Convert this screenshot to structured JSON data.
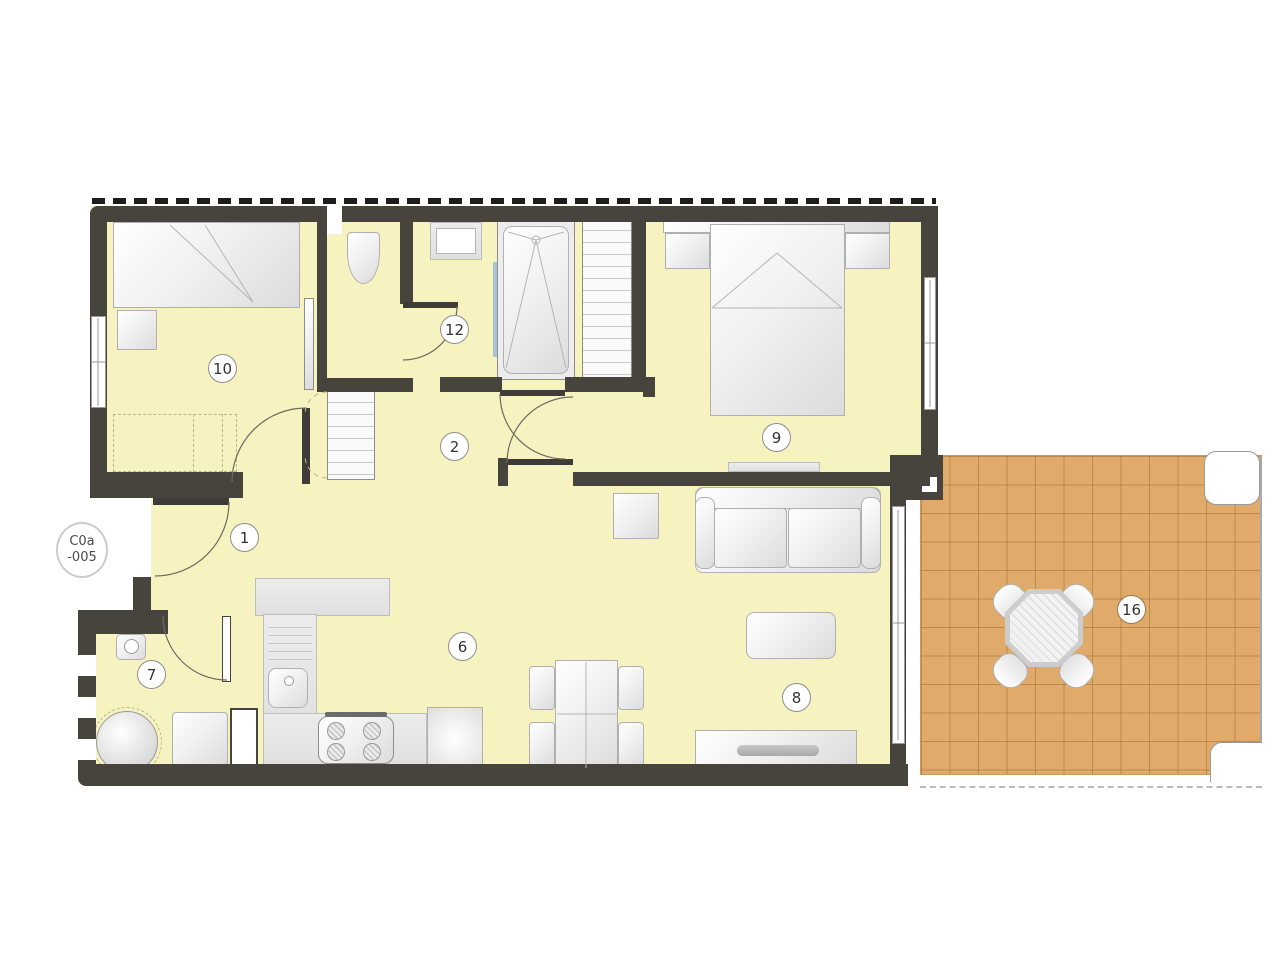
{
  "plan": {
    "unit_badge": {
      "line1": "C0a",
      "line2": "-005"
    },
    "room_labels": {
      "entrance": "1",
      "hallway": "2",
      "kitchen_dining": "6",
      "utility": "7",
      "living": "8",
      "bedroom_main": "9",
      "bedroom_second": "10",
      "bathroom": "12",
      "terrace": "16"
    },
    "colors": {
      "wall": "#47443e",
      "floor": "#f7f3c0",
      "terrace_tile": "#e0aa6a",
      "terrace_grid": "#a06e2d",
      "furniture_border": "#b0b0b0"
    }
  }
}
